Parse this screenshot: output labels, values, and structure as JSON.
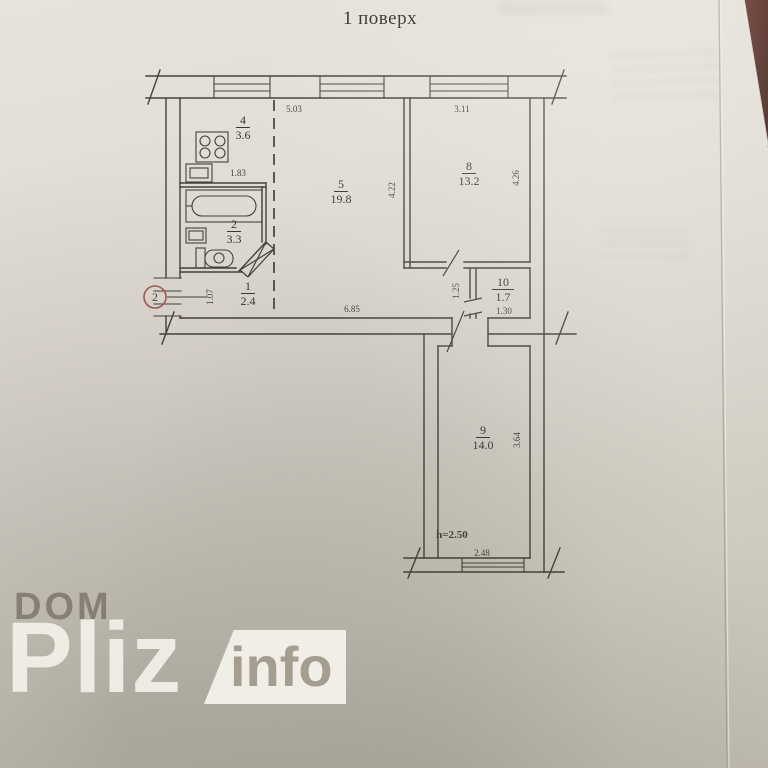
{
  "title": "1 поверх",
  "plan": {
    "rooms": [
      {
        "number": "4",
        "area": "3.6"
      },
      {
        "number": "5",
        "area": "19.8"
      },
      {
        "number": "8",
        "area": "13.2"
      },
      {
        "number": "2",
        "area": "3.3"
      },
      {
        "number": "1",
        "area": "2.4"
      },
      {
        "number": "10",
        "area": "1.7"
      },
      {
        "number": "9",
        "area": "14.0"
      }
    ],
    "dimensions": {
      "room5_top": "5.03",
      "room8_top": "3.11",
      "room5_side": "4.22",
      "room8_side": "4.26",
      "kitchen_bottom": "1.83",
      "entry_side": "1.07",
      "corridor_bottom": "6.85",
      "hall_side": "1.25",
      "room10_bottom": "1.30",
      "room9_side": "3.64",
      "ceiling_height": "h=2.50",
      "room9_bottom": "2.48"
    },
    "entrance_stamp": "2"
  },
  "watermark": {
    "line1": "DOM",
    "line2": "Pliz",
    "line3": "info"
  },
  "colors": {
    "ink": "#44403a",
    "paper": "#ded9d2",
    "stamp": "#a35a50",
    "table": "#4b1d15"
  }
}
